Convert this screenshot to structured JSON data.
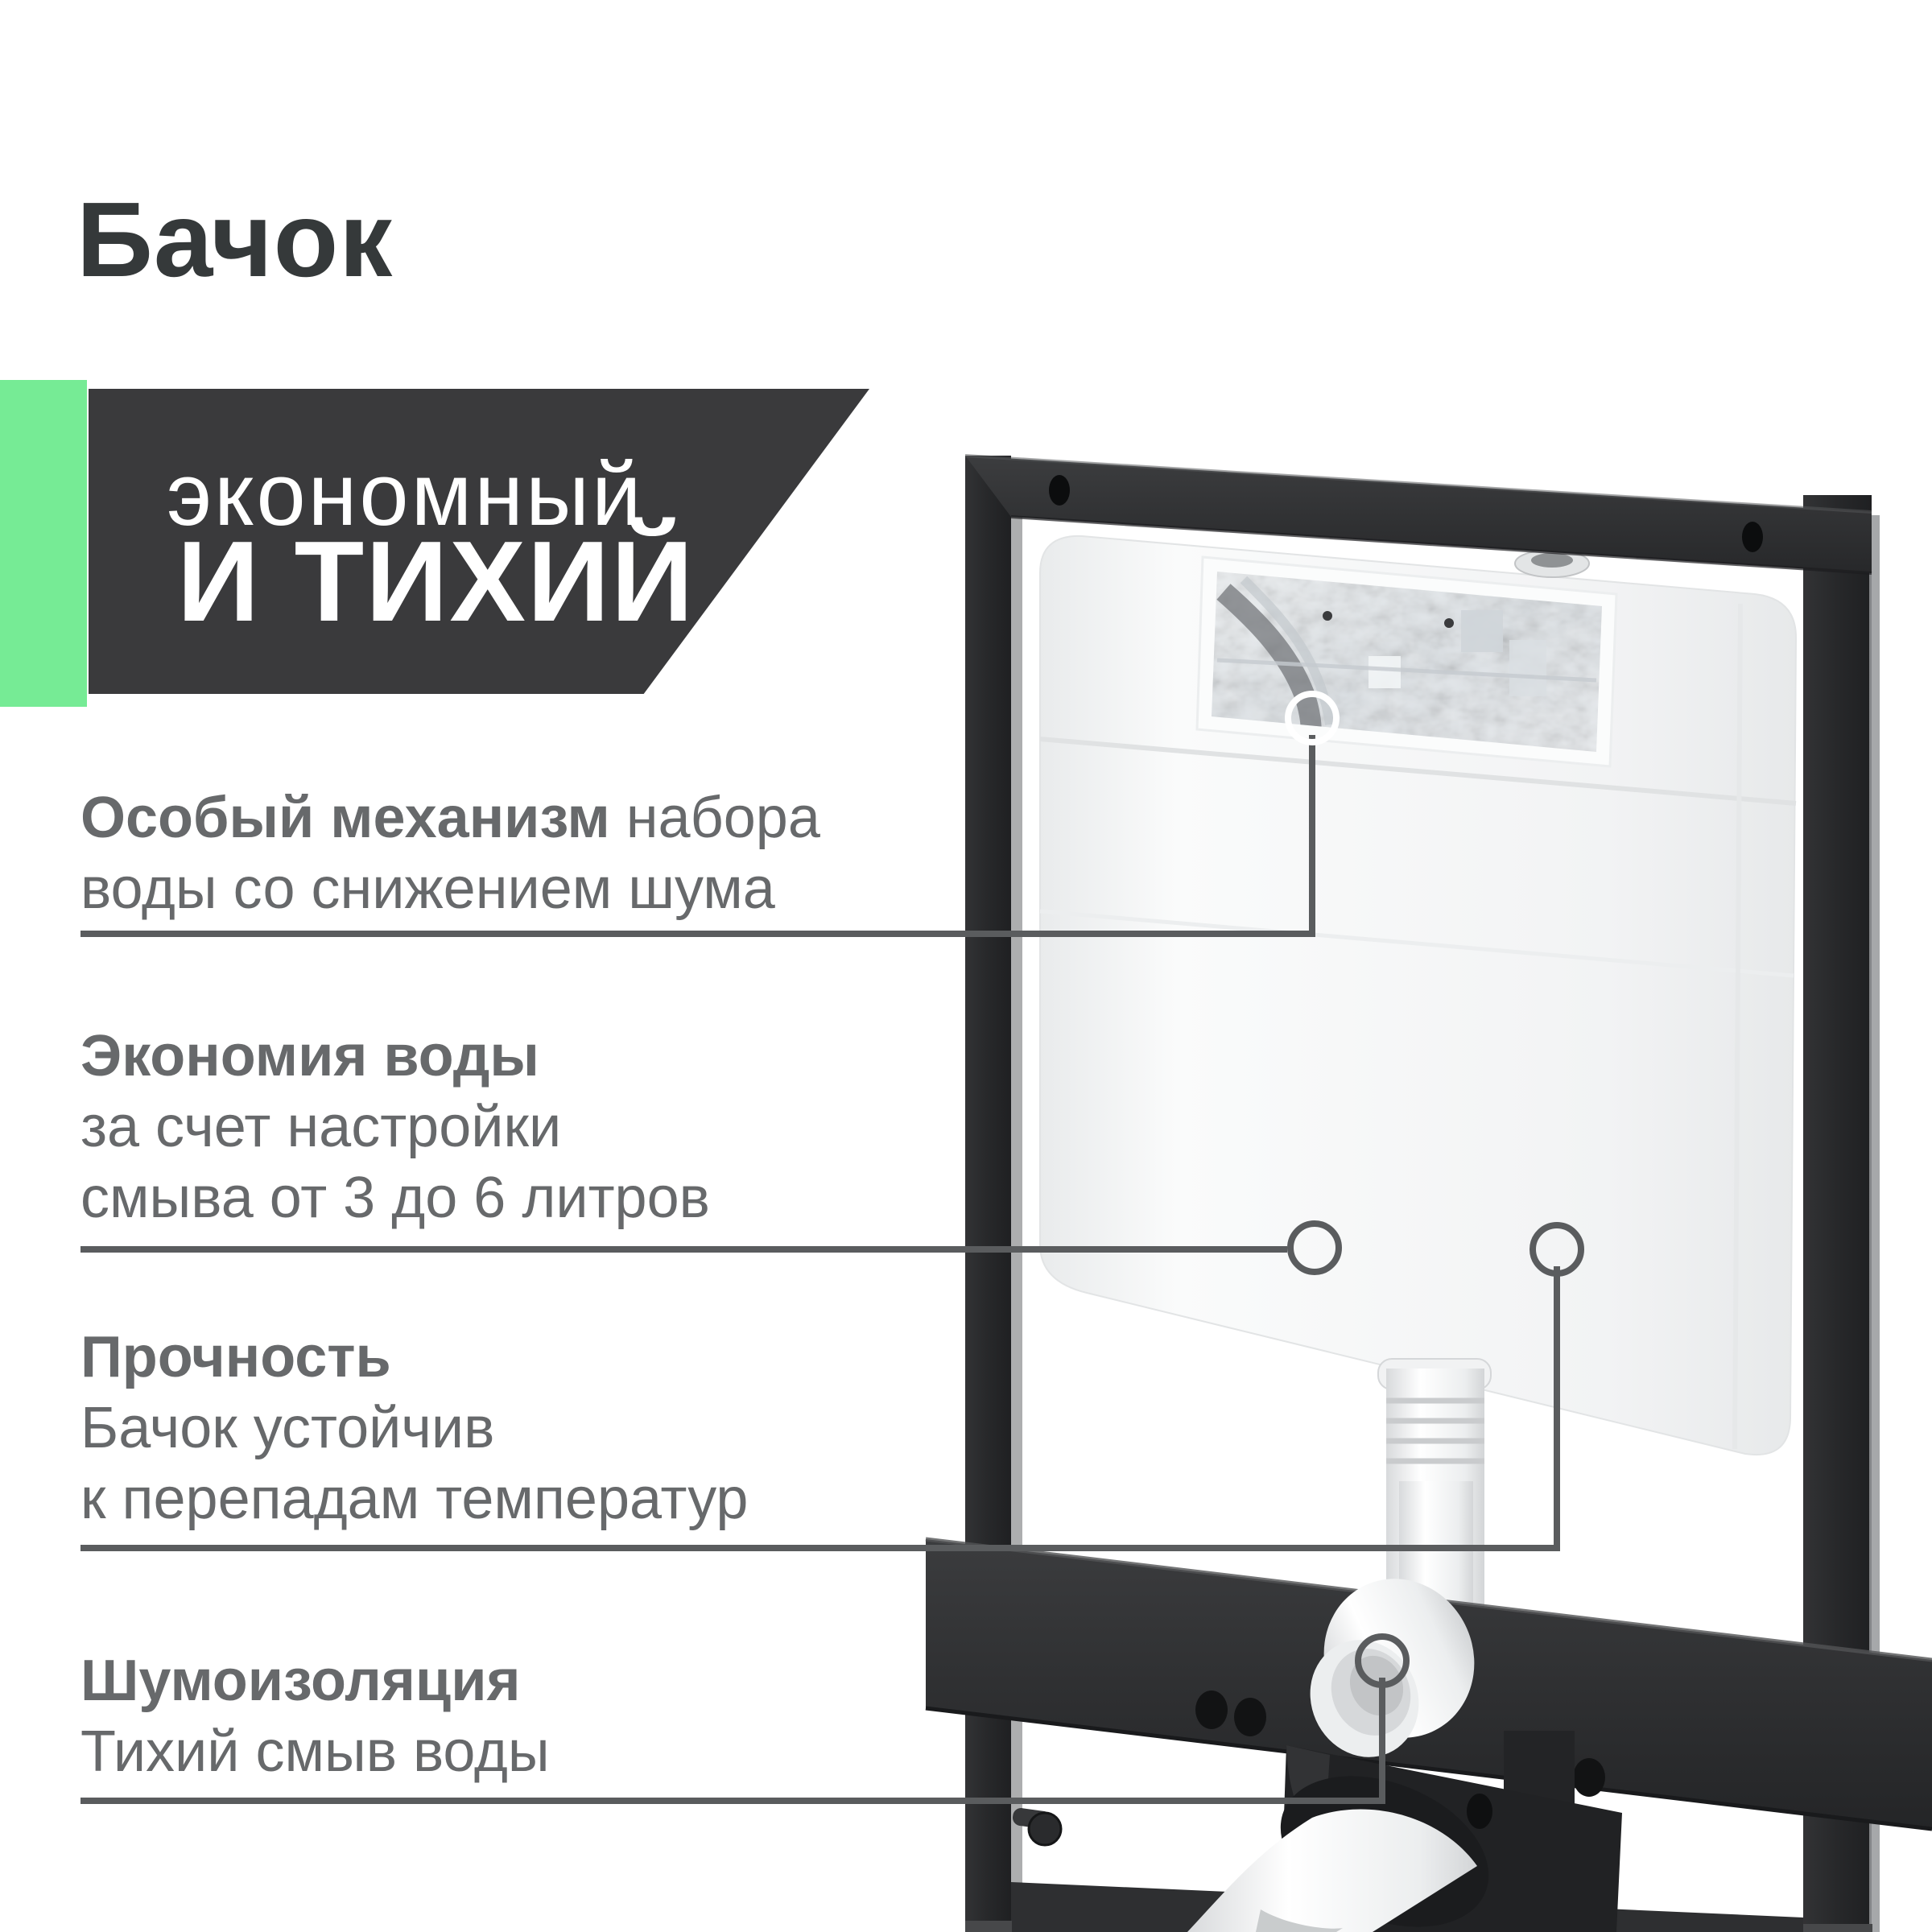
{
  "page_title": "Бачок",
  "badge": {
    "line1": "экономный",
    "line2": "И ТИХИЙ"
  },
  "features": [
    {
      "bold": "Особый механизм",
      "bold_suffix": " набора",
      "line2": "воды со снижением шума",
      "line3": ""
    },
    {
      "bold": "Экономия воды",
      "bold_suffix": "",
      "line2": "за счет настройки",
      "line3": "смыва от 3 до 6 литров"
    },
    {
      "bold": "Прочность",
      "bold_suffix": "",
      "line2": "Бачок устойчив",
      "line3": "к перепадам температур"
    },
    {
      "bold": "Шумоизоляция",
      "bold_suffix": "",
      "line2": "Тихий смыв воды",
      "line3": ""
    }
  ],
  "colors": {
    "accent_green": "#76eb95",
    "badge_dark": "#3a3a3c",
    "title_text": "#35393a",
    "body_text": "#67696b",
    "callout_line": "#5a5c5e"
  }
}
